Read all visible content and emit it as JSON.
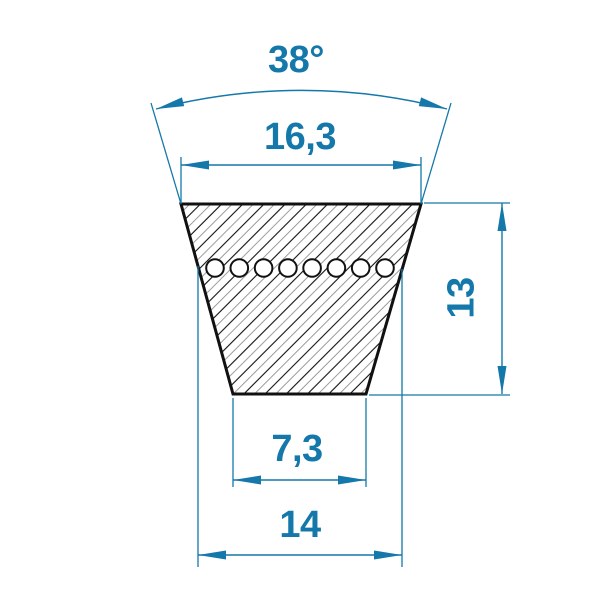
{
  "labels": {
    "angle": "38°",
    "top_width": "16,3",
    "height": "13",
    "bottom_width": "7,3",
    "datum_width": "14"
  },
  "colors": {
    "dimension_blue": "#1478aa",
    "outline_black": "#111111",
    "hatch_gray": "#9c9c9c",
    "background": "#ffffff"
  }
}
